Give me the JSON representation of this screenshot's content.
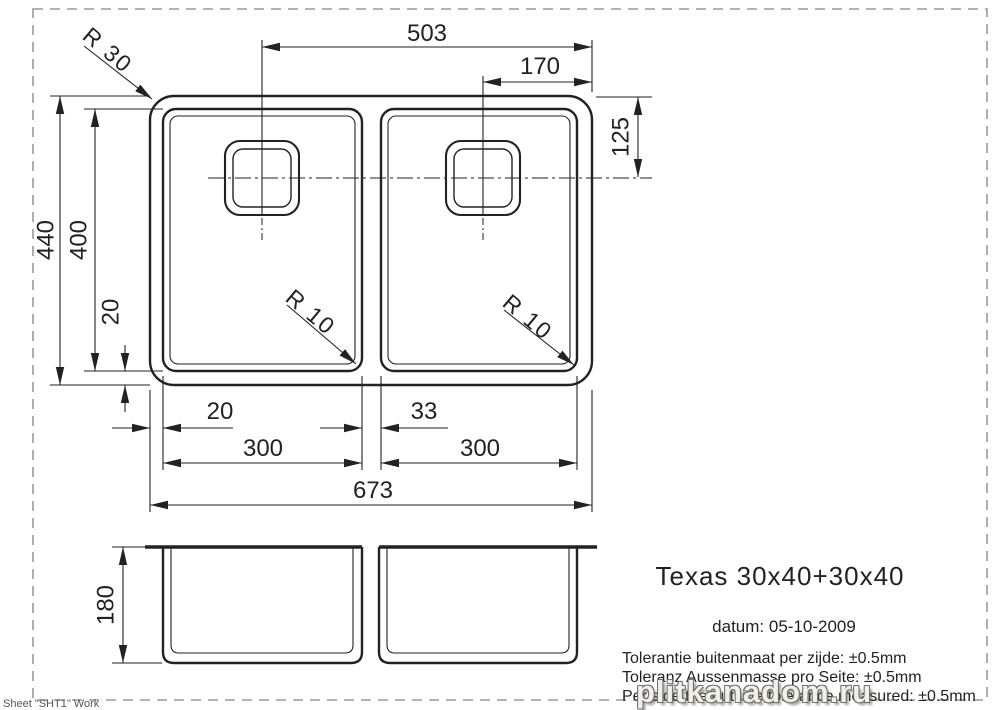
{
  "top_view": {
    "dim_drain_left_to_right_edge": "503",
    "dim_drain_right_to_right_edge": "170",
    "dim_drain_from_top_edge": "125",
    "radius_rim_corner": "R 30",
    "radius_bowl_left": "R 10",
    "radius_bowl_right": "R 10",
    "dim_overall_depth": "440",
    "dim_bowl_depth": "400",
    "dim_rim_to_bowl_vertical": "20",
    "dim_rim_to_bowl_bottom": "20",
    "dim_divider_width": "33",
    "dim_bowl_width_left": "300",
    "dim_bowl_width_right": "300",
    "dim_overall_width": "673"
  },
  "side_view": {
    "dim_bowl_height": "180"
  },
  "title_block": {
    "model": "Texas 30x40+30x40",
    "date_line": "datum: 05-10-2009",
    "tolerances": [
      "Tolerantie buitenmaat per zijde: ±0.5mm",
      "Toleranz Aussenmasse pro Seite: ±0.5mm",
      "Per side the outside tolerance measured: ±0.5mm"
    ]
  },
  "sheet_label": "Sheet \"SHT1\" Work",
  "watermark": "plitkanadom.ru",
  "colors": {
    "line": "#222222",
    "border_dash": "#9a9a9a",
    "background": "#ffffff"
  }
}
